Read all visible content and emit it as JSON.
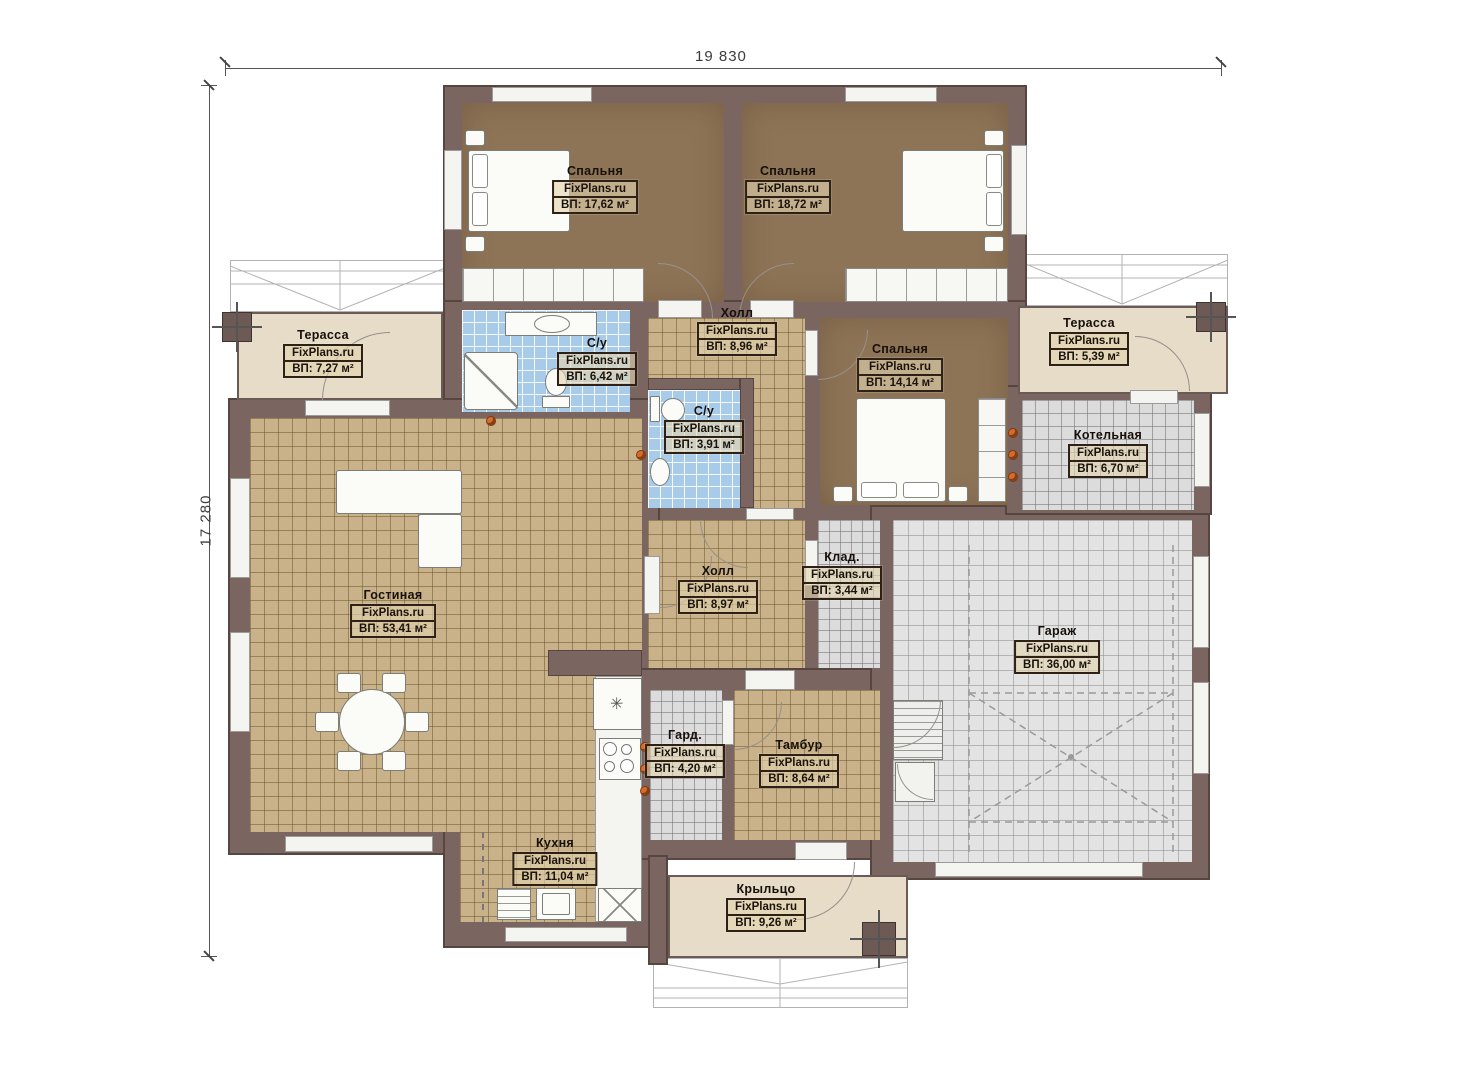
{
  "watermark": "FixPlans.ru",
  "dimensions": {
    "width": "19 830",
    "height": "17 280"
  },
  "rooms": [
    {
      "id": "bedroom-1",
      "name": "Спальня",
      "area": "ВП: 17,62 м²"
    },
    {
      "id": "bedroom-2",
      "name": "Спальня",
      "area": "ВП: 18,72 м²"
    },
    {
      "id": "terrace-left",
      "name": "Терасса",
      "area": "ВП: 7,27 м²"
    },
    {
      "id": "bathroom-1",
      "name": "С/у",
      "area": "ВП: 6,42 м²"
    },
    {
      "id": "hall-1",
      "name": "Холл",
      "area": "ВП: 8,96 м²"
    },
    {
      "id": "bedroom-3",
      "name": "Спальня",
      "area": "ВП: 14,14 м²"
    },
    {
      "id": "terrace-right",
      "name": "Терасса",
      "area": "ВП: 5,39 м²"
    },
    {
      "id": "bathroom-2",
      "name": "С/у",
      "area": "ВП: 3,91 м²"
    },
    {
      "id": "boiler-room",
      "name": "Котельная",
      "area": "ВП: 6,70 м²"
    },
    {
      "id": "living-room",
      "name": "Гостиная",
      "area": "ВП: 53,41 м²"
    },
    {
      "id": "hall-2",
      "name": "Холл",
      "area": "ВП: 8,97 м²"
    },
    {
      "id": "storage",
      "name": "Клад.",
      "area": "ВП: 3,44 м²"
    },
    {
      "id": "garage",
      "name": "Гараж",
      "area": "ВП: 36,00 м²"
    },
    {
      "id": "wardrobe",
      "name": "Гард.",
      "area": "ВП: 4,20 м²"
    },
    {
      "id": "vestibule",
      "name": "Тамбур",
      "area": "ВП: 8,64 м²"
    },
    {
      "id": "kitchen",
      "name": "Кухня",
      "area": "ВП: 11,04 м²"
    },
    {
      "id": "porch",
      "name": "Крыльцо",
      "area": "ВП: 9,26 м²"
    }
  ],
  "icons": {
    "star": "✳"
  },
  "colors": {
    "wall": "#7A6560",
    "bedroom_floor": "#8E7457",
    "tile_tan": "#C9B189",
    "tile_blue": "#A9CBEA",
    "tile_grey": "#DCDCDC",
    "garage_floor": "#E3E3E3",
    "terrace_floor": "#E6DCC8",
    "vent_accent": "#D96A2B"
  }
}
